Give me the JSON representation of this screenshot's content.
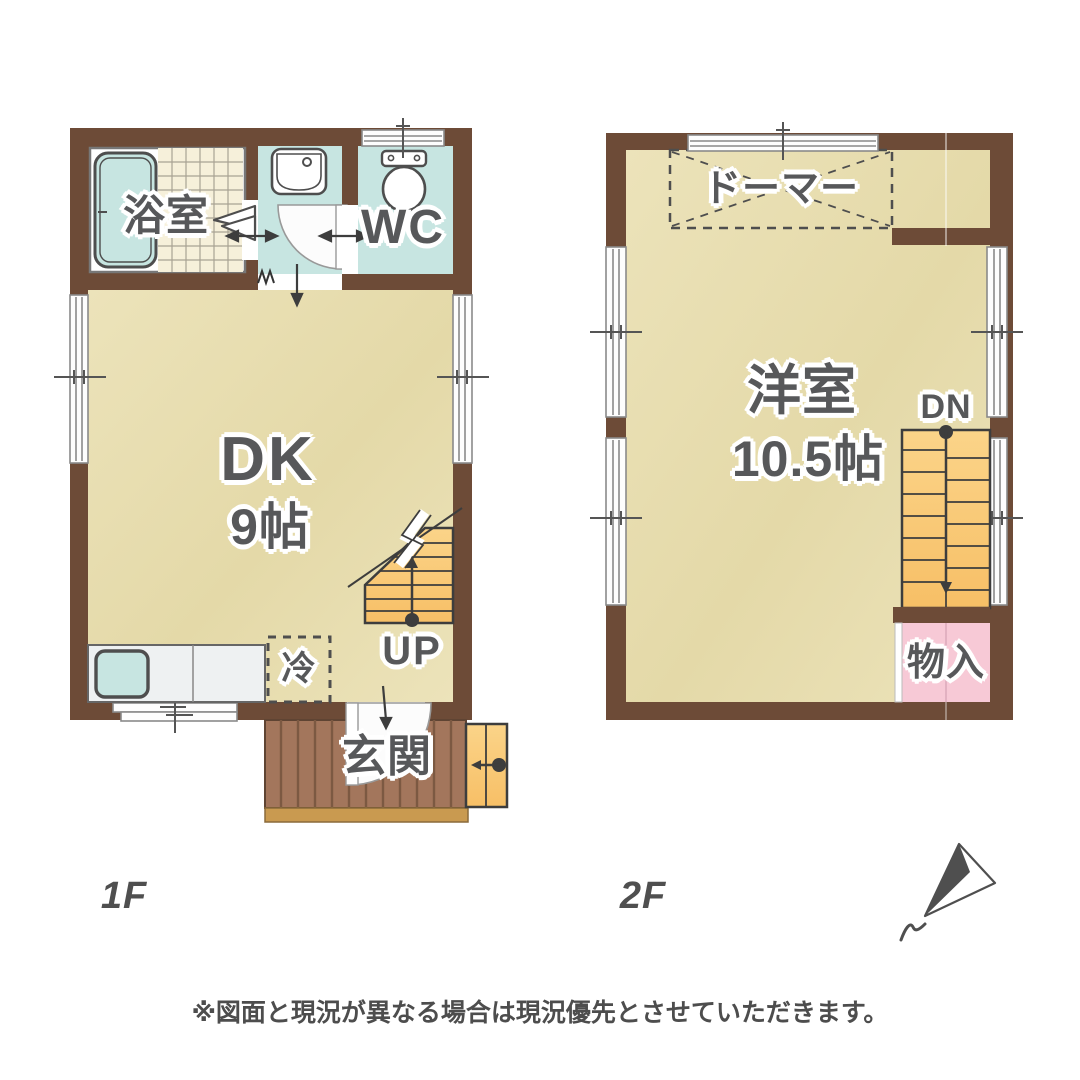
{
  "floor1": {
    "floor_label": "1F",
    "bath": "浴室",
    "wc": "WC",
    "dk": "DK",
    "dk_size": "9帖",
    "fridge": "冷",
    "stairs": "UP",
    "entrance": "玄関"
  },
  "floor2": {
    "floor_label": "2F",
    "dormer": "ドーマー",
    "room": "洋室",
    "room_size": "10.5帖",
    "stairs": "DN",
    "storage": "物入"
  },
  "footer": {
    "disclaimer": "※図面と現況が異なる場合は現況優先とさせていただきます。"
  },
  "colors": {
    "wall": "#6d4b37",
    "floor-a": "#ece3ba",
    "floor-b": "#e4d9a8",
    "wet": "#c7e5e1",
    "tile": "#f6f0da",
    "stair": "#f7bf66",
    "deck": "#a3765c",
    "plank": "#7c5942",
    "step": "#c99a50",
    "storage": "#f7c9d6",
    "ink": "#3d3d3d",
    "text": "#57585a",
    "frame": "#8a8a8a"
  }
}
